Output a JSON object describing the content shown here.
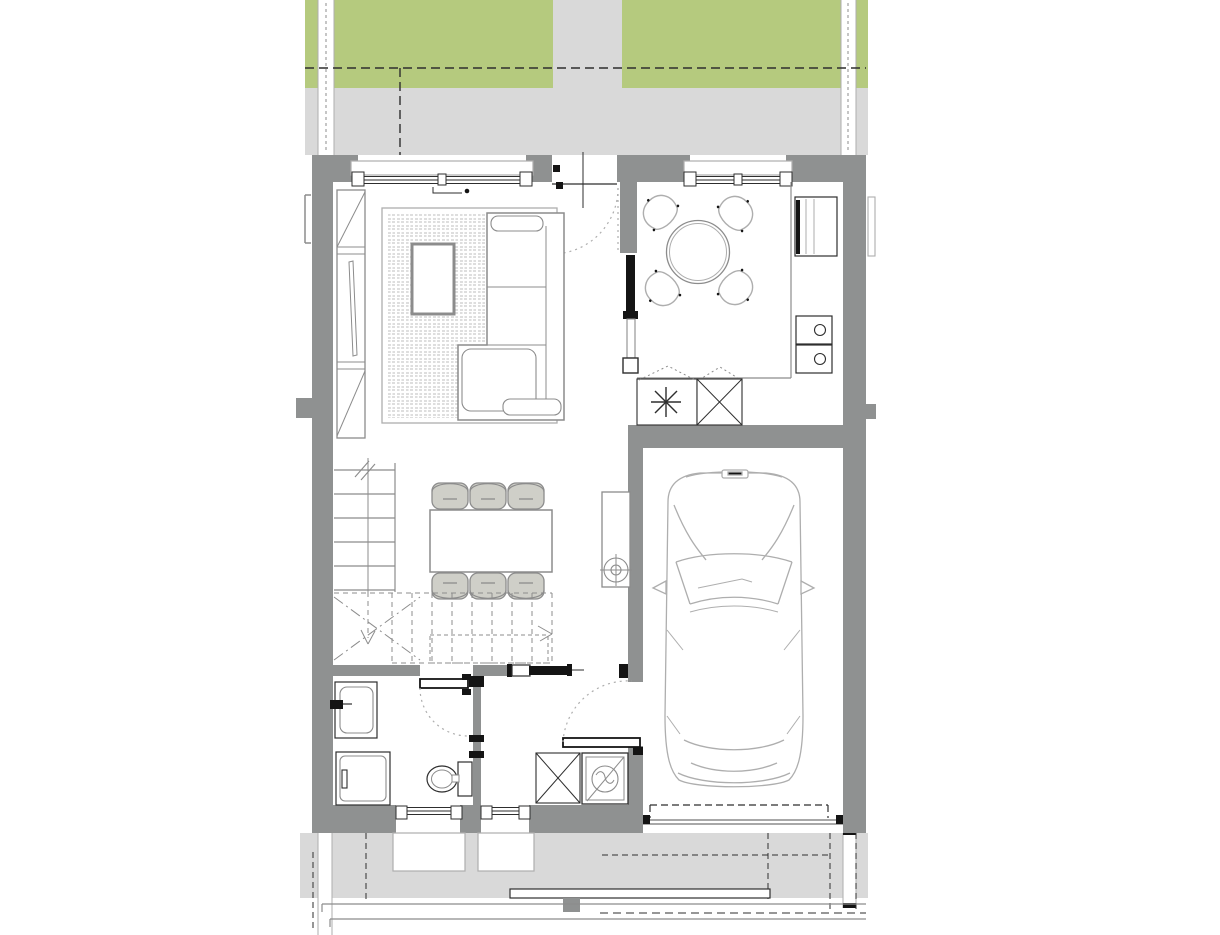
{
  "drawing": {
    "kind": "architectural-floor-plan",
    "storey": "ground-floor",
    "text_labels": [],
    "palette": {
      "lawn": "#b5ca7e",
      "paving": "#d9d9d9",
      "wall": "#8f9191",
      "white": "#ffffff",
      "line": "#2e2e2e",
      "dark": "#141414",
      "furniture_line": "#8c8c8c",
      "light_line": "#aeaeae",
      "chair_fill": "#cfcfc8",
      "rug_pattern": "#bcbcbc"
    },
    "site_features": [
      "lawn-strips",
      "entrance-footpath",
      "rear-terrace",
      "front-driveway",
      "dashed-property-lines",
      "street-edge-lines",
      "kerb-step",
      "gate-post"
    ],
    "rooms": [
      {
        "id": "living-room",
        "contents": [
          "window",
          "entrance-door",
          "wardrobe",
          "area-rug",
          "coffee-table",
          "corner-sofa",
          "switch-symbol"
        ]
      },
      {
        "id": "kitchen",
        "contents": [
          "window",
          "pocket-door",
          "round-table",
          "four-chairs",
          "counter",
          "fridge",
          "hob-unit",
          "boiler-niche",
          "duct-shaft"
        ]
      },
      {
        "id": "dining-hall",
        "contents": [
          "dining-table",
          "six-chairs",
          "staircase",
          "utility-cabinet"
        ]
      },
      {
        "id": "bathroom",
        "contents": [
          "washbasin",
          "shower",
          "toilet",
          "swing-door",
          "window"
        ]
      },
      {
        "id": "vestibule",
        "contents": [
          "sliding-door",
          "washing-machine",
          "duct-shaft",
          "garage-swing-door",
          "window"
        ]
      },
      {
        "id": "garage",
        "contents": [
          "car",
          "sectional-door-dashed",
          "threshold"
        ]
      }
    ]
  }
}
